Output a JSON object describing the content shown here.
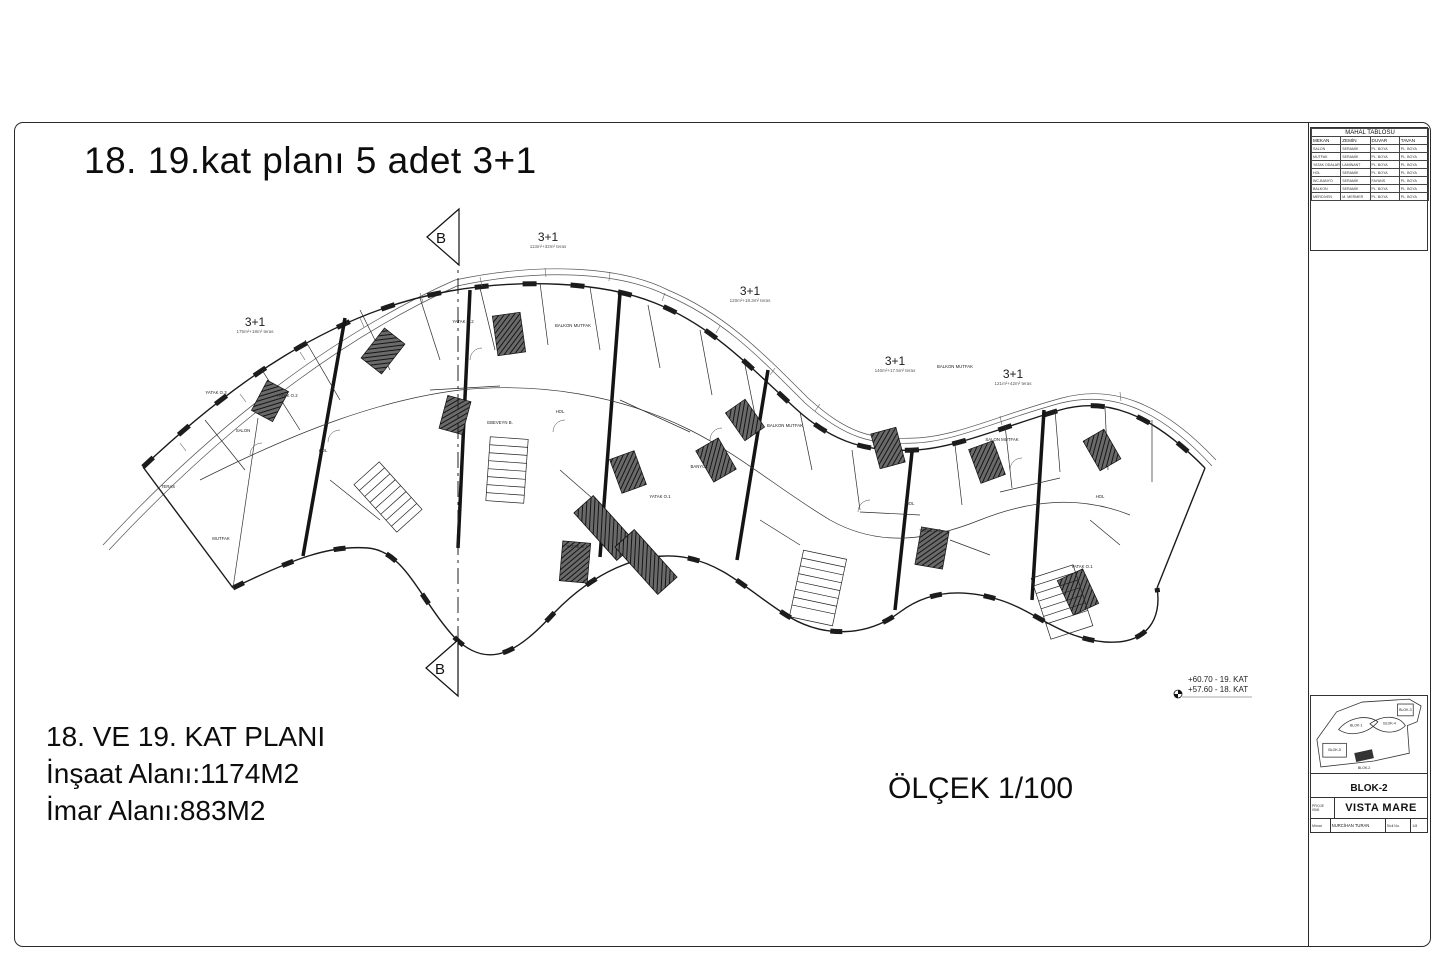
{
  "sheet": {
    "title": "18. 19.kat planı 5 adet 3+1",
    "scale": "ÖLÇEK 1/100"
  },
  "summary": {
    "line1": "18. VE 19. KAT PLANI",
    "line2": "İnşaat Alanı:1174M2",
    "line3": "İmar Alanı:883M2"
  },
  "section": {
    "label": "B"
  },
  "units": [
    {
      "type": "3+1",
      "area": "175m²+18m² teras"
    },
    {
      "type": "3+1",
      "area": "113m²+32m² teras"
    },
    {
      "type": "3+1",
      "area": "120m²+18.3m² teras"
    },
    {
      "type": "3+1",
      "area": "140m²+17.5m² teras"
    },
    {
      "type": "3+1",
      "area": "121m²+42m² teras"
    }
  ],
  "elevations": {
    "line1": "+60.70 - 19. KAT",
    "line2": "+57.60 - 18. KAT"
  },
  "mahal_table": {
    "title": "MAHAL TABLOSU",
    "columns": [
      "MEKAN",
      "ZEMİN",
      "DUVAR",
      "TAVAN"
    ],
    "rows": [
      [
        "SALON",
        "SERAMİK",
        "PL. BOYA",
        "PL. BOYA"
      ],
      [
        "MUTFAK",
        "SERAMİK",
        "PL. BOYA",
        "PL. BOYA"
      ],
      [
        "YATAK ODALARI",
        "LAMİNANT",
        "PL. BOYA",
        "PL. BOYA"
      ],
      [
        "HOL",
        "SERAMİK",
        "PL. BOYA",
        "PL. BOYA"
      ],
      [
        "WC-BANYO",
        "SERAMİK",
        "FAYANS",
        "PL. BOYA"
      ],
      [
        "BALKON",
        "SERAMİK",
        "PL. BOYA",
        "PL. BOYA"
      ],
      [
        "MERDİVEN",
        "M. MERMER",
        "PL. BOYA",
        "PL. BOYA"
      ]
    ]
  },
  "title_block": {
    "block_label": "BLOK-2",
    "project_label_1": "PROJE",
    "project_label_2": "İSMİ",
    "project_name": "VISTA MARE",
    "architect_label": "Mimar",
    "architect_name": "NURCİHAN TURAN",
    "reg_label": "Sicil No.",
    "reg_value": "1/8",
    "keyplan_blocks": [
      "BLOK-1",
      "BLOK-4",
      "BLOK-3",
      "BLOK-5",
      "BLOK-2"
    ]
  },
  "plan_labels": [
    {
      "t": "TERAS",
      "x": 168,
      "y": 488
    },
    {
      "t": "SALON",
      "x": 243,
      "y": 432
    },
    {
      "t": "MUTFAK",
      "x": 221,
      "y": 540
    },
    {
      "t": "YATAK O.3",
      "x": 216,
      "y": 394
    },
    {
      "t": "YATAK O.2",
      "x": 287,
      "y": 397
    },
    {
      "t": "HOL",
      "x": 323,
      "y": 452
    },
    {
      "t": "EBEVEYN B.",
      "x": 500,
      "y": 424
    },
    {
      "t": "YATAK O.2",
      "x": 463,
      "y": 323
    },
    {
      "t": "BALKON MUTFAK",
      "x": 573,
      "y": 327
    },
    {
      "t": "HOL",
      "x": 560,
      "y": 413
    },
    {
      "t": "YATAK O.1",
      "x": 577,
      "y": 548
    },
    {
      "t": "BALKON MUTFAK",
      "x": 785,
      "y": 427
    },
    {
      "t": "YATAK O.1",
      "x": 660,
      "y": 498
    },
    {
      "t": "BANYO",
      "x": 698,
      "y": 468
    },
    {
      "t": "BALKON MUTFAK",
      "x": 955,
      "y": 368
    },
    {
      "t": "SALON MUTFAK",
      "x": 1002,
      "y": 441
    },
    {
      "t": "HOL",
      "x": 910,
      "y": 505
    },
    {
      "t": "YATAK O.2",
      "x": 930,
      "y": 532
    },
    {
      "t": "HOL",
      "x": 1100,
      "y": 498
    },
    {
      "t": "YATAK O.1",
      "x": 1082,
      "y": 568
    }
  ]
}
